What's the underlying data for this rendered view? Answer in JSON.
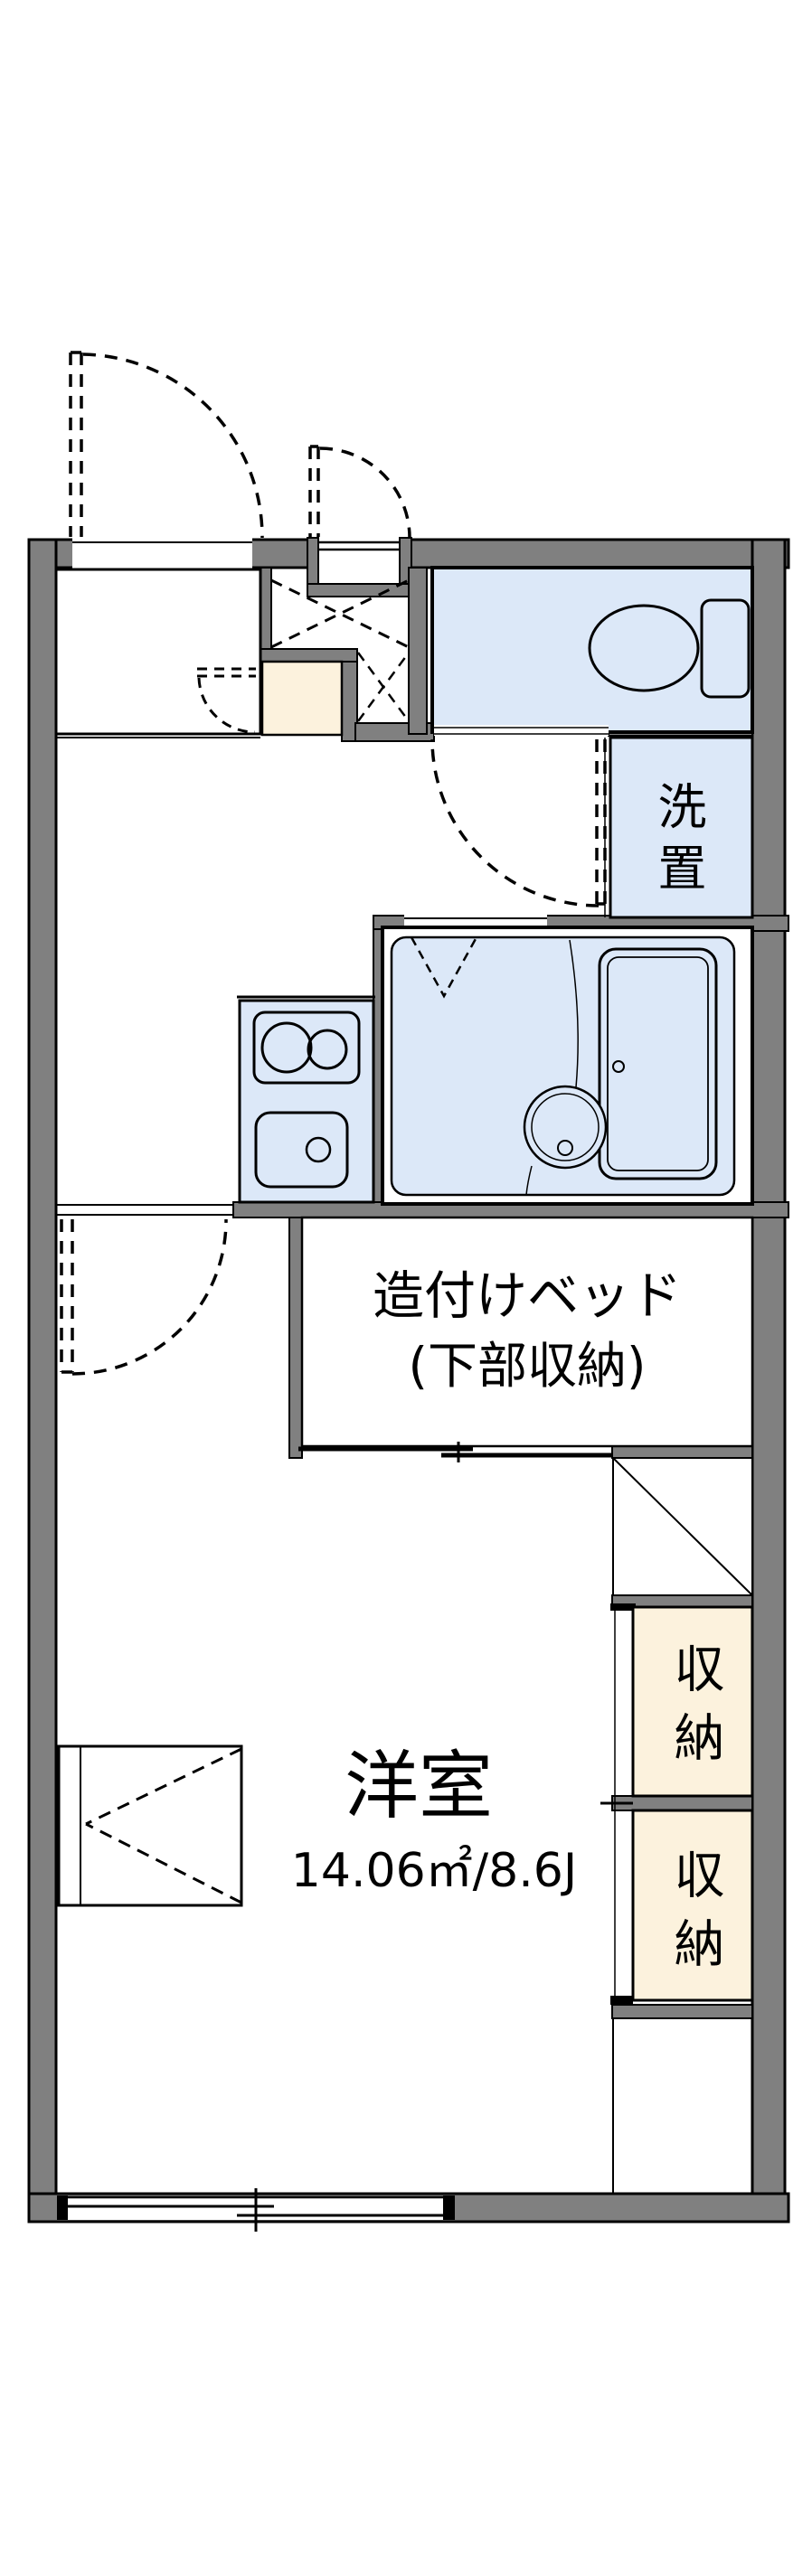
{
  "document": {
    "type": "apartment-floor-plan"
  },
  "labels": {
    "washer": "洗置",
    "bed_line1": "造付けベッド",
    "bed_line2": "(下部収納)",
    "room_name": "洋室",
    "room_area": "14.06㎡/8.6J",
    "storage_upper": "収納",
    "storage_lower": "収納"
  },
  "colors": {
    "wall_gray": "#808080",
    "wet_area_blue": "#dce8f8",
    "storage_cream": "#fcf2dd",
    "line_black": "#000000",
    "background": "#ffffff"
  },
  "icons": [
    "toilet-icon",
    "toilet-tank-icon",
    "bathtub-icon",
    "wash-basin-icon",
    "stove-burners-icon",
    "kitchen-sink-icon",
    "entry-door-swing-icon",
    "service-door-swing-icon",
    "toilet-door-swing-icon",
    "hallway-door-swing-icon",
    "folding-bath-door-icon",
    "overhead-closet-x-icon",
    "refrigerator-space-icon",
    "sliding-window-icon",
    "bay-counter-icon",
    "shoe-cabinet-door-swing-icon"
  ]
}
